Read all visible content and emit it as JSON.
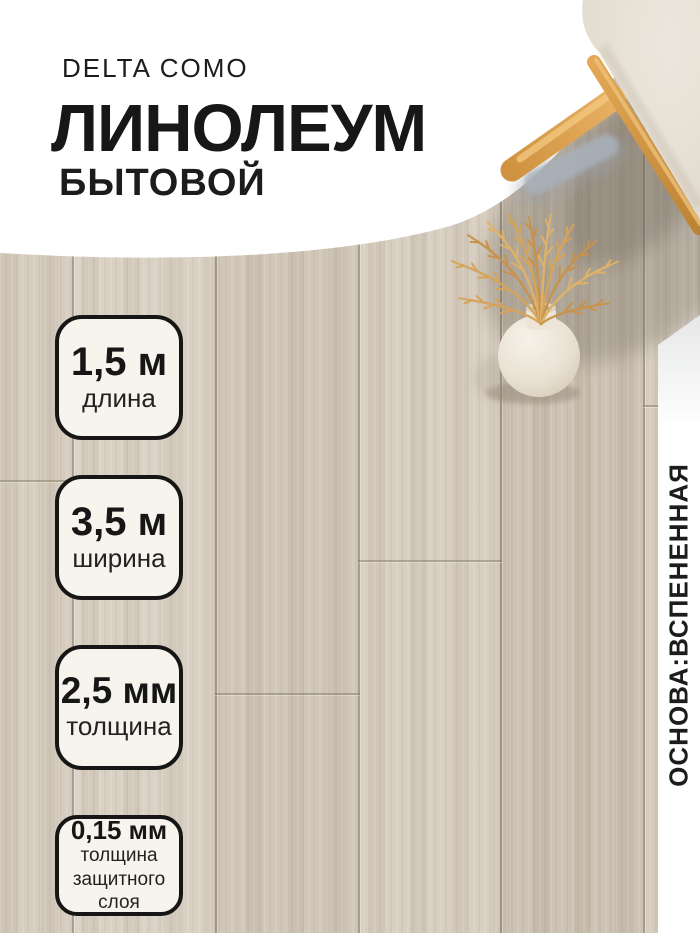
{
  "product": {
    "brand": "DELTA COMO",
    "title": "ЛИНОЛЕУМ",
    "subtitle": "БЫТОВОЙ"
  },
  "specs": [
    {
      "value": "1,5 м",
      "label": "длина"
    },
    {
      "value": "3,5 м",
      "label": "ширина"
    },
    {
      "value": "2,5 мм",
      "label": "толщина"
    },
    {
      "value": "0,15 мм",
      "label": "толщина защитного слоя"
    }
  ],
  "side_note": "ОСНОВА:ВСПЕНЕННАЯ",
  "colors": {
    "text": "#191919",
    "badge_border": "#161616",
    "badge_bg": "#f7f4ee",
    "wood_base": "#cfc5b6",
    "white_overlay": "#ffffff",
    "wheat_gold": "#d2a055",
    "stool_wood": "#d99f4c",
    "cushion": "#e7e1d5"
  }
}
